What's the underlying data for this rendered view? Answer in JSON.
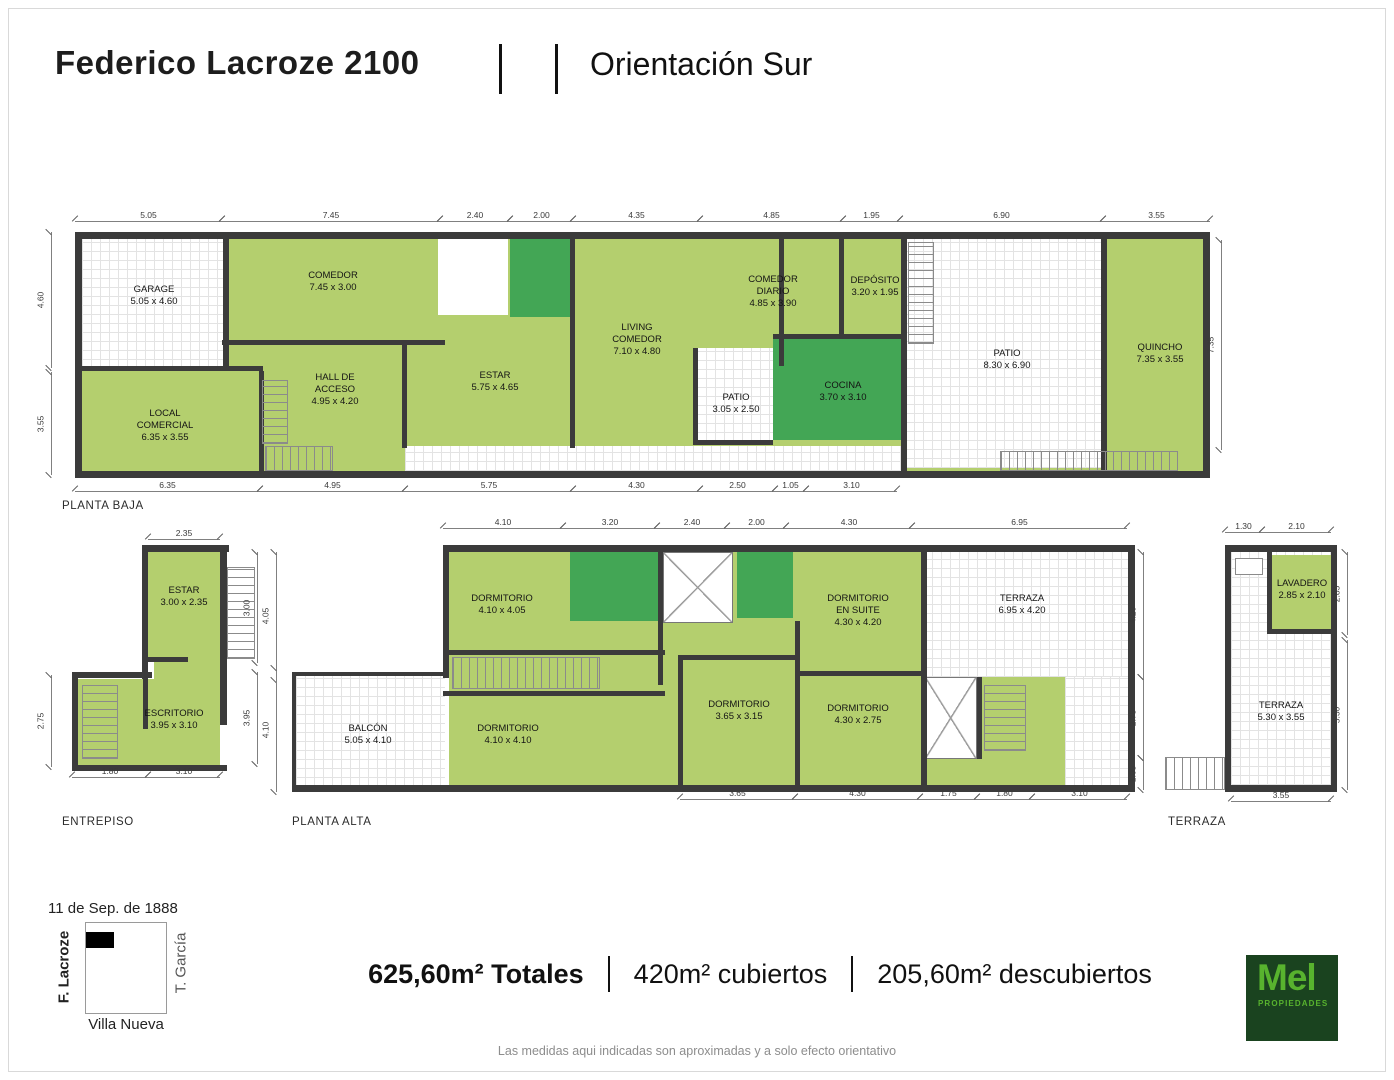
{
  "header": {
    "title": "Federico Lacroze 2100",
    "orientation": "Orientación Sur"
  },
  "colors": {
    "room_green": "#b4cf6e",
    "wet_green": "#43a655",
    "wall": "#3b3b3b",
    "grid_line": "#e3e3e3",
    "logo_bg": "#1a431f",
    "logo_green": "#58b32e"
  },
  "plans": [
    {
      "label": "PLANTA BAJA",
      "label_pos": {
        "x": 62,
        "y": 500
      },
      "frame": {
        "x": 75,
        "y": 232,
        "w": 1135,
        "h": 246
      },
      "shapes": [
        {
          "k": "base",
          "x": 7,
          "y": 7,
          "w": 1121,
          "h": 232
        },
        {
          "k": "openg",
          "x": 7,
          "y": 7,
          "w": 144,
          "h": 130
        },
        {
          "k": "open",
          "x": 363,
          "y": 7,
          "w": 70,
          "h": 76
        },
        {
          "k": "openg",
          "x": 622,
          "y": 116,
          "w": 76,
          "h": 94
        },
        {
          "k": "openg",
          "x": 830,
          "y": 7,
          "w": 198,
          "h": 229
        },
        {
          "k": "openg",
          "x": 330,
          "y": 214,
          "w": 500,
          "h": 25
        },
        {
          "k": "wet",
          "x": 435,
          "y": 7,
          "w": 64,
          "h": 78
        },
        {
          "k": "wet",
          "x": 698,
          "y": 106,
          "w": 130,
          "h": 102
        },
        {
          "k": "wall",
          "x": 0,
          "y": 0,
          "w": 1135,
          "h": 7
        },
        {
          "k": "wall",
          "x": 0,
          "y": 239,
          "w": 1135,
          "h": 7
        },
        {
          "k": "wall",
          "x": 0,
          "y": 0,
          "w": 7,
          "h": 246
        },
        {
          "k": "wall",
          "x": 1128,
          "y": 0,
          "w": 7,
          "h": 246
        },
        {
          "k": "wall",
          "x": 148,
          "y": 0,
          "w": 6,
          "h": 138
        },
        {
          "k": "wall",
          "x": 0,
          "y": 134,
          "w": 188,
          "h": 5
        },
        {
          "k": "wall",
          "x": 147,
          "y": 108,
          "w": 223,
          "h": 5
        },
        {
          "k": "wall",
          "x": 184,
          "y": 139,
          "w": 5,
          "h": 100
        },
        {
          "k": "wall",
          "x": 327,
          "y": 108,
          "w": 5,
          "h": 108
        },
        {
          "k": "wall",
          "x": 495,
          "y": 7,
          "w": 5,
          "h": 209
        },
        {
          "k": "wall",
          "x": 704,
          "y": 7,
          "w": 5,
          "h": 127
        },
        {
          "k": "wall",
          "x": 698,
          "y": 102,
          "w": 130,
          "h": 5
        },
        {
          "k": "wall",
          "x": 764,
          "y": 7,
          "w": 5,
          "h": 97
        },
        {
          "k": "wall",
          "x": 826,
          "y": 0,
          "w": 6,
          "h": 239
        },
        {
          "k": "wall",
          "x": 1026,
          "y": 0,
          "w": 6,
          "h": 239
        },
        {
          "k": "wall",
          "x": 618,
          "y": 116,
          "w": 5,
          "h": 96
        },
        {
          "k": "wall",
          "x": 618,
          "y": 208,
          "w": 80,
          "h": 5
        },
        {
          "k": "stv",
          "x": 187,
          "y": 148,
          "w": 26,
          "h": 64
        },
        {
          "k": "sth",
          "x": 190,
          "y": 214,
          "w": 68,
          "h": 25
        },
        {
          "k": "stv",
          "x": 833,
          "y": 10,
          "w": 26,
          "h": 102
        },
        {
          "k": "sth",
          "x": 925,
          "y": 219,
          "w": 178,
          "h": 20
        }
      ],
      "rooms": [
        {
          "name": "GARAGE",
          "dims": "5.05 x 4.60",
          "cx": 79,
          "cy": 64
        },
        {
          "name": "COMEDOR",
          "dims": "7.45 x 3.00",
          "cx": 258,
          "cy": 50
        },
        {
          "name": "HALL DE\nACCESO",
          "dims": "4.95 x 4.20",
          "cx": 260,
          "cy": 158
        },
        {
          "name": "LOCAL\nCOMERCIAL",
          "dims": "6.35 x 3.55",
          "cx": 90,
          "cy": 194
        },
        {
          "name": "ESTAR",
          "dims": "5.75 x 4.65",
          "cx": 420,
          "cy": 150
        },
        {
          "name": "LIVING\nCOMEDOR",
          "dims": "7.10 x 4.80",
          "cx": 562,
          "cy": 108
        },
        {
          "name": "PATIO",
          "dims": "3.05 x 2.50",
          "cx": 661,
          "cy": 172
        },
        {
          "name": "COMEDOR\nDIARIO",
          "dims": "4.85 x 3.90",
          "cx": 698,
          "cy": 60
        },
        {
          "name": "DEPÓSITO",
          "dims": "3.20 x 1.95",
          "cx": 800,
          "cy": 55
        },
        {
          "name": "COCINA",
          "dims": "3.70 x 3.10",
          "cx": 768,
          "cy": 160
        },
        {
          "name": "PATIO",
          "dims": "8.30 x 6.90",
          "cx": 932,
          "cy": 128
        },
        {
          "name": "QUINCHO",
          "dims": "7.35 x 3.55",
          "cx": 1085,
          "cy": 122
        }
      ]
    },
    {
      "label": "ENTREPISO",
      "label_pos": {
        "x": 62,
        "y": 816
      },
      "frame": {
        "x": 70,
        "y": 545,
        "w": 190,
        "h": 228
      },
      "shapes": [
        {
          "k": "open",
          "x": 157,
          "y": 22,
          "w": 28,
          "h": 92
        },
        {
          "k": "stv",
          "x": 157,
          "y": 22,
          "w": 28,
          "h": 92
        },
        {
          "k": "base",
          "x": 78,
          "y": 7,
          "w": 72,
          "h": 110
        },
        {
          "k": "base",
          "x": 84,
          "y": 117,
          "w": 66,
          "h": 20
        },
        {
          "k": "base",
          "x": 8,
          "y": 134,
          "w": 142,
          "h": 86
        },
        {
          "k": "wall",
          "x": 78,
          "y": 0,
          "w": 81,
          "h": 7
        },
        {
          "k": "wall",
          "x": 72,
          "y": 0,
          "w": 6,
          "h": 134
        },
        {
          "k": "wall",
          "x": 150,
          "y": 0,
          "w": 7,
          "h": 180
        },
        {
          "k": "wall",
          "x": 78,
          "y": 112,
          "w": 40,
          "h": 5
        },
        {
          "k": "wall",
          "x": 2,
          "y": 127,
          "w": 80,
          "h": 6
        },
        {
          "k": "wall",
          "x": 2,
          "y": 127,
          "w": 6,
          "h": 99
        },
        {
          "k": "wall",
          "x": 2,
          "y": 220,
          "w": 155,
          "h": 6
        },
        {
          "k": "wall",
          "x": 73,
          "y": 134,
          "w": 5,
          "h": 50
        },
        {
          "k": "stv",
          "x": 12,
          "y": 140,
          "w": 36,
          "h": 74
        }
      ],
      "rooms": [
        {
          "name": "ESTAR",
          "dims": "3.00 x 2.35",
          "cx": 114,
          "cy": 52
        },
        {
          "name": "ESCRITORIO",
          "dims": "3.95 x 3.10",
          "cx": 104,
          "cy": 175
        }
      ]
    },
    {
      "label": "PLANTA ALTA",
      "label_pos": {
        "x": 292,
        "y": 816
      },
      "frame": {
        "x": 292,
        "y": 545,
        "w": 843,
        "h": 247
      },
      "shapes": [
        {
          "k": "base",
          "x": 157,
          "y": 7,
          "w": 679,
          "h": 233
        },
        {
          "k": "openg",
          "x": 4,
          "y": 131,
          "w": 149,
          "h": 111
        },
        {
          "k": "openg",
          "x": 631,
          "y": 7,
          "w": 205,
          "h": 125
        },
        {
          "k": "openg",
          "x": 773,
          "y": 132,
          "w": 63,
          "h": 110
        },
        {
          "k": "xroom",
          "x": 371,
          "y": 7,
          "w": 70,
          "h": 71
        },
        {
          "k": "xroom",
          "x": 633,
          "y": 132,
          "w": 52,
          "h": 82
        },
        {
          "k": "wet",
          "x": 278,
          "y": 7,
          "w": 93,
          "h": 69
        },
        {
          "k": "wet",
          "x": 445,
          "y": 7,
          "w": 56,
          "h": 66
        },
        {
          "k": "wall",
          "x": 151,
          "y": 0,
          "w": 692,
          "h": 7
        },
        {
          "k": "wall",
          "x": 0,
          "y": 240,
          "w": 843,
          "h": 7
        },
        {
          "k": "wall",
          "x": 836,
          "y": 0,
          "w": 7,
          "h": 247
        },
        {
          "k": "wall",
          "x": 151,
          "y": 0,
          "w": 6,
          "h": 133
        },
        {
          "k": "wall",
          "x": 0,
          "y": 127,
          "w": 153,
          "h": 4
        },
        {
          "k": "wall",
          "x": 0,
          "y": 127,
          "w": 4,
          "h": 117
        },
        {
          "k": "wall",
          "x": 151,
          "y": 105,
          "w": 222,
          "h": 5
        },
        {
          "k": "wall",
          "x": 151,
          "y": 146,
          "w": 222,
          "h": 5
        },
        {
          "k": "wall",
          "x": 366,
          "y": 0,
          "w": 5,
          "h": 140
        },
        {
          "k": "wall",
          "x": 503,
          "y": 76,
          "w": 5,
          "h": 164
        },
        {
          "k": "wall",
          "x": 503,
          "y": 126,
          "w": 130,
          "h": 5
        },
        {
          "k": "wall",
          "x": 629,
          "y": 0,
          "w": 6,
          "h": 240
        },
        {
          "k": "wall",
          "x": 685,
          "y": 132,
          "w": 5,
          "h": 82
        },
        {
          "k": "wall",
          "x": 386,
          "y": 110,
          "w": 5,
          "h": 130
        },
        {
          "k": "wall",
          "x": 386,
          "y": 110,
          "w": 122,
          "h": 5
        },
        {
          "k": "sth",
          "x": 160,
          "y": 112,
          "w": 148,
          "h": 32
        },
        {
          "k": "stv",
          "x": 692,
          "y": 140,
          "w": 42,
          "h": 66
        }
      ],
      "rooms": [
        {
          "name": "DORMITORIO",
          "dims": "4.10 x 4.05",
          "cx": 210,
          "cy": 60
        },
        {
          "name": "DORMITORIO",
          "dims": "4.10 x 4.10",
          "cx": 216,
          "cy": 190
        },
        {
          "name": "BALCÓN",
          "dims": "5.05 x 4.10",
          "cx": 76,
          "cy": 190
        },
        {
          "name": "DORMITORIO\nEN SUITE",
          "dims": "4.30 x 4.20",
          "cx": 566,
          "cy": 66
        },
        {
          "name": "TERRAZA",
          "dims": "6.95 x 4.20",
          "cx": 730,
          "cy": 60
        },
        {
          "name": "DORMITORIO",
          "dims": "3.65 x 3.15",
          "cx": 447,
          "cy": 166
        },
        {
          "name": "DORMITORIO",
          "dims": "4.30 x 2.75",
          "cx": 566,
          "cy": 170
        }
      ]
    },
    {
      "label": "TERRAZA",
      "label_pos": {
        "x": 1168,
        "y": 816
      },
      "frame": {
        "x": 1225,
        "y": 545,
        "w": 112,
        "h": 247
      },
      "shapes": [
        {
          "k": "openg",
          "x": 6,
          "y": 7,
          "w": 100,
          "h": 233
        },
        {
          "k": "base",
          "x": 47,
          "y": 10,
          "w": 59,
          "h": 79
        },
        {
          "k": "wall",
          "x": 0,
          "y": 0,
          "w": 112,
          "h": 7
        },
        {
          "k": "wall",
          "x": 0,
          "y": 0,
          "w": 6,
          "h": 247
        },
        {
          "k": "wall",
          "x": 106,
          "y": 0,
          "w": 6,
          "h": 247
        },
        {
          "k": "wall",
          "x": 0,
          "y": 240,
          "w": 112,
          "h": 7
        },
        {
          "k": "wall",
          "x": 42,
          "y": 7,
          "w": 5,
          "h": 82
        },
        {
          "k": "wall",
          "x": 42,
          "y": 84,
          "w": 64,
          "h": 5
        },
        {
          "k": "box",
          "x": 10,
          "y": 13,
          "w": 28,
          "h": 17
        },
        {
          "k": "open",
          "x": -60,
          "y": 212,
          "w": 60,
          "h": 33
        },
        {
          "k": "sth",
          "x": -60,
          "y": 212,
          "w": 60,
          "h": 33
        }
      ],
      "rooms": [
        {
          "name": "LAVADERO",
          "dims": "2.85 x 2.10",
          "cx": 77,
          "cy": 45
        },
        {
          "name": "TERRAZA",
          "dims": "5.30 x 3.55",
          "cx": 56,
          "cy": 167
        }
      ]
    }
  ],
  "dims": [
    {
      "t": "5.05",
      "o": "h",
      "x": 75,
      "y": 222,
      "len": 147
    },
    {
      "t": "7.45",
      "o": "h",
      "x": 222,
      "y": 222,
      "len": 218
    },
    {
      "t": "2.40",
      "o": "h",
      "x": 440,
      "y": 222,
      "len": 70
    },
    {
      "t": "2.00",
      "o": "h",
      "x": 510,
      "y": 222,
      "len": 63
    },
    {
      "t": "4.35",
      "o": "h",
      "x": 573,
      "y": 222,
      "len": 127
    },
    {
      "t": "4.85",
      "o": "h",
      "x": 700,
      "y": 222,
      "len": 143
    },
    {
      "t": "1.95",
      "o": "h",
      "x": 843,
      "y": 222,
      "len": 57
    },
    {
      "t": "6.90",
      "o": "h",
      "x": 900,
      "y": 222,
      "len": 203
    },
    {
      "t": "3.55",
      "o": "h",
      "x": 1103,
      "y": 222,
      "len": 107
    },
    {
      "t": "4.60",
      "o": "v",
      "x": 56,
      "y": 232,
      "len": 136
    },
    {
      "t": "3.55",
      "o": "v",
      "x": 56,
      "y": 372,
      "len": 103
    },
    {
      "t": "7.35",
      "o": "v",
      "x": 1226,
      "y": 240,
      "len": 210
    },
    {
      "t": "6.35",
      "o": "h",
      "x": 75,
      "y": 492,
      "len": 185
    },
    {
      "t": "4.95",
      "o": "h",
      "x": 260,
      "y": 492,
      "len": 145
    },
    {
      "t": "5.75",
      "o": "h",
      "x": 405,
      "y": 492,
      "len": 168
    },
    {
      "t": "4.30",
      "o": "h",
      "x": 573,
      "y": 492,
      "len": 127
    },
    {
      "t": "2.50",
      "o": "h",
      "x": 700,
      "y": 492,
      "len": 75
    },
    {
      "t": "1.05",
      "o": "h",
      "x": 775,
      "y": 492,
      "len": 31
    },
    {
      "t": "3.10",
      "o": "h",
      "x": 806,
      "y": 492,
      "len": 91
    },
    {
      "t": "2.35",
      "o": "h",
      "x": 148,
      "y": 540,
      "len": 72
    },
    {
      "t": "2.75",
      "o": "v",
      "x": 56,
      "y": 675,
      "len": 92
    },
    {
      "t": "1.80",
      "o": "h",
      "x": 72,
      "y": 778,
      "len": 76
    },
    {
      "t": "3.10",
      "o": "h",
      "x": 148,
      "y": 778,
      "len": 72
    },
    {
      "t": "3.00",
      "o": "v",
      "x": 262,
      "y": 552,
      "len": 111
    },
    {
      "t": "4.05",
      "o": "v",
      "x": 281,
      "y": 552,
      "len": 128
    },
    {
      "t": "3.95",
      "o": "v",
      "x": 262,
      "y": 672,
      "len": 92
    },
    {
      "t": "4.10",
      "o": "v",
      "x": 281,
      "y": 668,
      "len": 124
    },
    {
      "t": "4.10",
      "o": "h",
      "x": 443,
      "y": 529,
      "len": 120
    },
    {
      "t": "3.20",
      "o": "h",
      "x": 563,
      "y": 529,
      "len": 94
    },
    {
      "t": "2.40",
      "o": "h",
      "x": 657,
      "y": 529,
      "len": 70
    },
    {
      "t": "2.00",
      "o": "h",
      "x": 727,
      "y": 529,
      "len": 59
    },
    {
      "t": "4.30",
      "o": "h",
      "x": 786,
      "y": 529,
      "len": 126
    },
    {
      "t": "6.95",
      "o": "h",
      "x": 912,
      "y": 529,
      "len": 215
    },
    {
      "t": "4.20",
      "o": "v",
      "x": 1148,
      "y": 552,
      "len": 125
    },
    {
      "t": "2.75",
      "o": "v",
      "x": 1148,
      "y": 677,
      "len": 81
    },
    {
      "t": "1.05",
      "o": "v",
      "x": 1148,
      "y": 758,
      "len": 32
    },
    {
      "t": "3.65",
      "o": "h",
      "x": 680,
      "y": 800,
      "len": 115
    },
    {
      "t": "4.30",
      "o": "h",
      "x": 795,
      "y": 800,
      "len": 125
    },
    {
      "t": "1.75",
      "o": "h",
      "x": 920,
      "y": 800,
      "len": 57
    },
    {
      "t": "1.80",
      "o": "h",
      "x": 977,
      "y": 800,
      "len": 55
    },
    {
      "t": "3.10",
      "o": "h",
      "x": 1032,
      "y": 800,
      "len": 95
    },
    {
      "t": "1.30",
      "o": "h",
      "x": 1225,
      "y": 533,
      "len": 37
    },
    {
      "t": "2.10",
      "o": "h",
      "x": 1262,
      "y": 533,
      "len": 69
    },
    {
      "t": "2.85",
      "o": "v",
      "x": 1352,
      "y": 552,
      "len": 83
    },
    {
      "t": "5.30",
      "o": "v",
      "x": 1352,
      "y": 640,
      "len": 150
    },
    {
      "t": "3.55",
      "o": "h",
      "x": 1231,
      "y": 802,
      "len": 100
    }
  ],
  "map": {
    "date": "11 de Sep. de 1888",
    "left_street": "F. Lacroze",
    "right_street": "T. García",
    "bottom_street": "Villa Nueva"
  },
  "areas": {
    "total": "625,60m² Totales",
    "covered": "420m² cubiertos",
    "uncovered": "205,60m² descubiertos"
  },
  "logo": {
    "name": "Mel",
    "sub": "PROPIEDADES"
  },
  "disclaimer": "Las medidas aqui indicadas son aproximadas y a solo efecto orientativo"
}
